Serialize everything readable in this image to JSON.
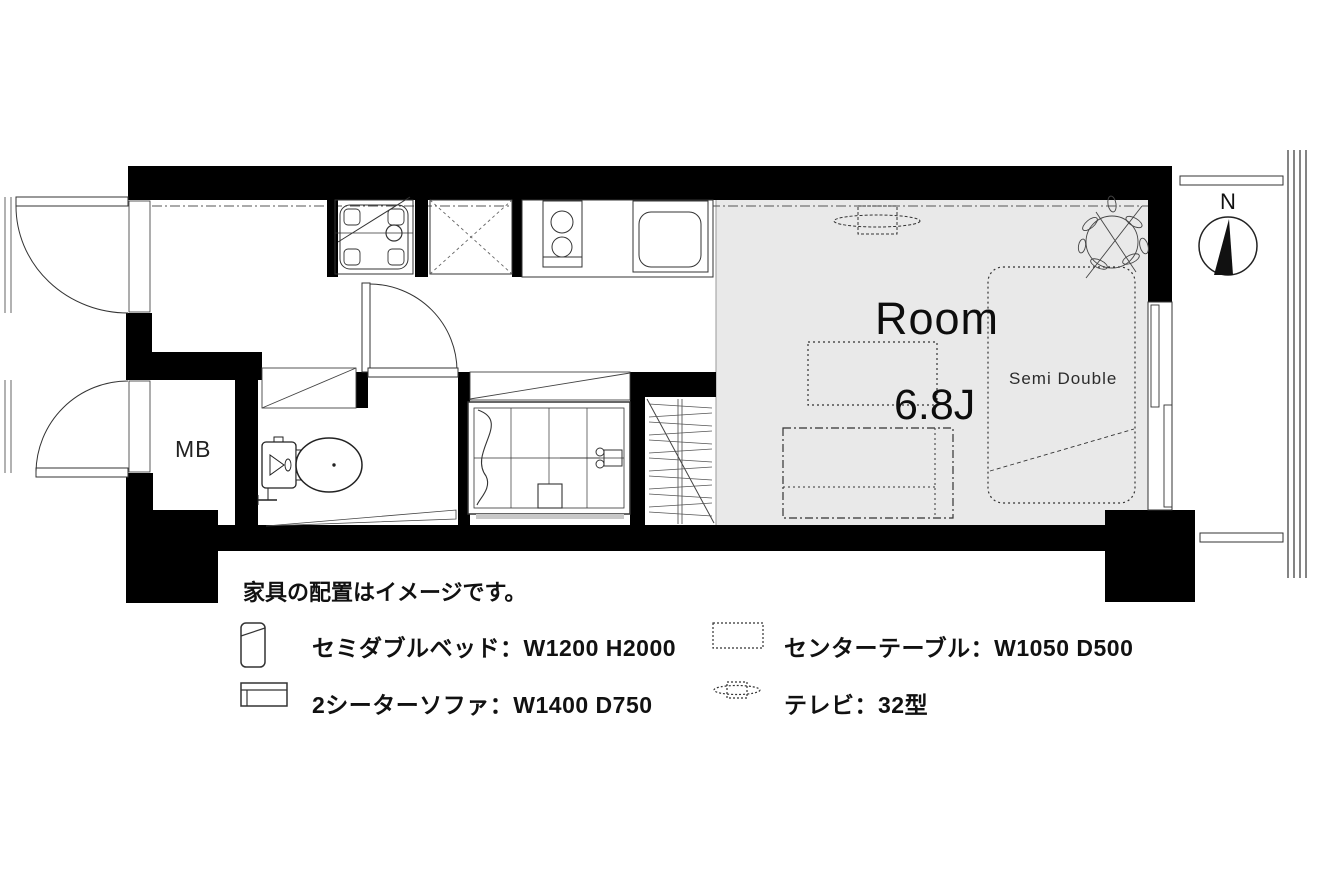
{
  "plan": {
    "room_name": "Room",
    "room_size": "6.8J",
    "bed_label": "Semi Double",
    "meter_box": "MB",
    "compass_north": "N"
  },
  "legend": {
    "note": "家具の配置はイメージです。",
    "items": [
      {
        "icon": "bed-icon",
        "label": "セミダブルベッド：W1200 H2000"
      },
      {
        "icon": "sofa-icon",
        "label": "2シーターソファ：W1400 D750"
      },
      {
        "icon": "table-icon",
        "label": "センターテーブル：W1050 D500"
      },
      {
        "icon": "tv-icon",
        "label": "テレビ：32型"
      }
    ]
  },
  "colors": {
    "wall": "#000000",
    "room_fill": "#e9e9e9",
    "line": "#2b2b2b",
    "background": "#ffffff"
  }
}
